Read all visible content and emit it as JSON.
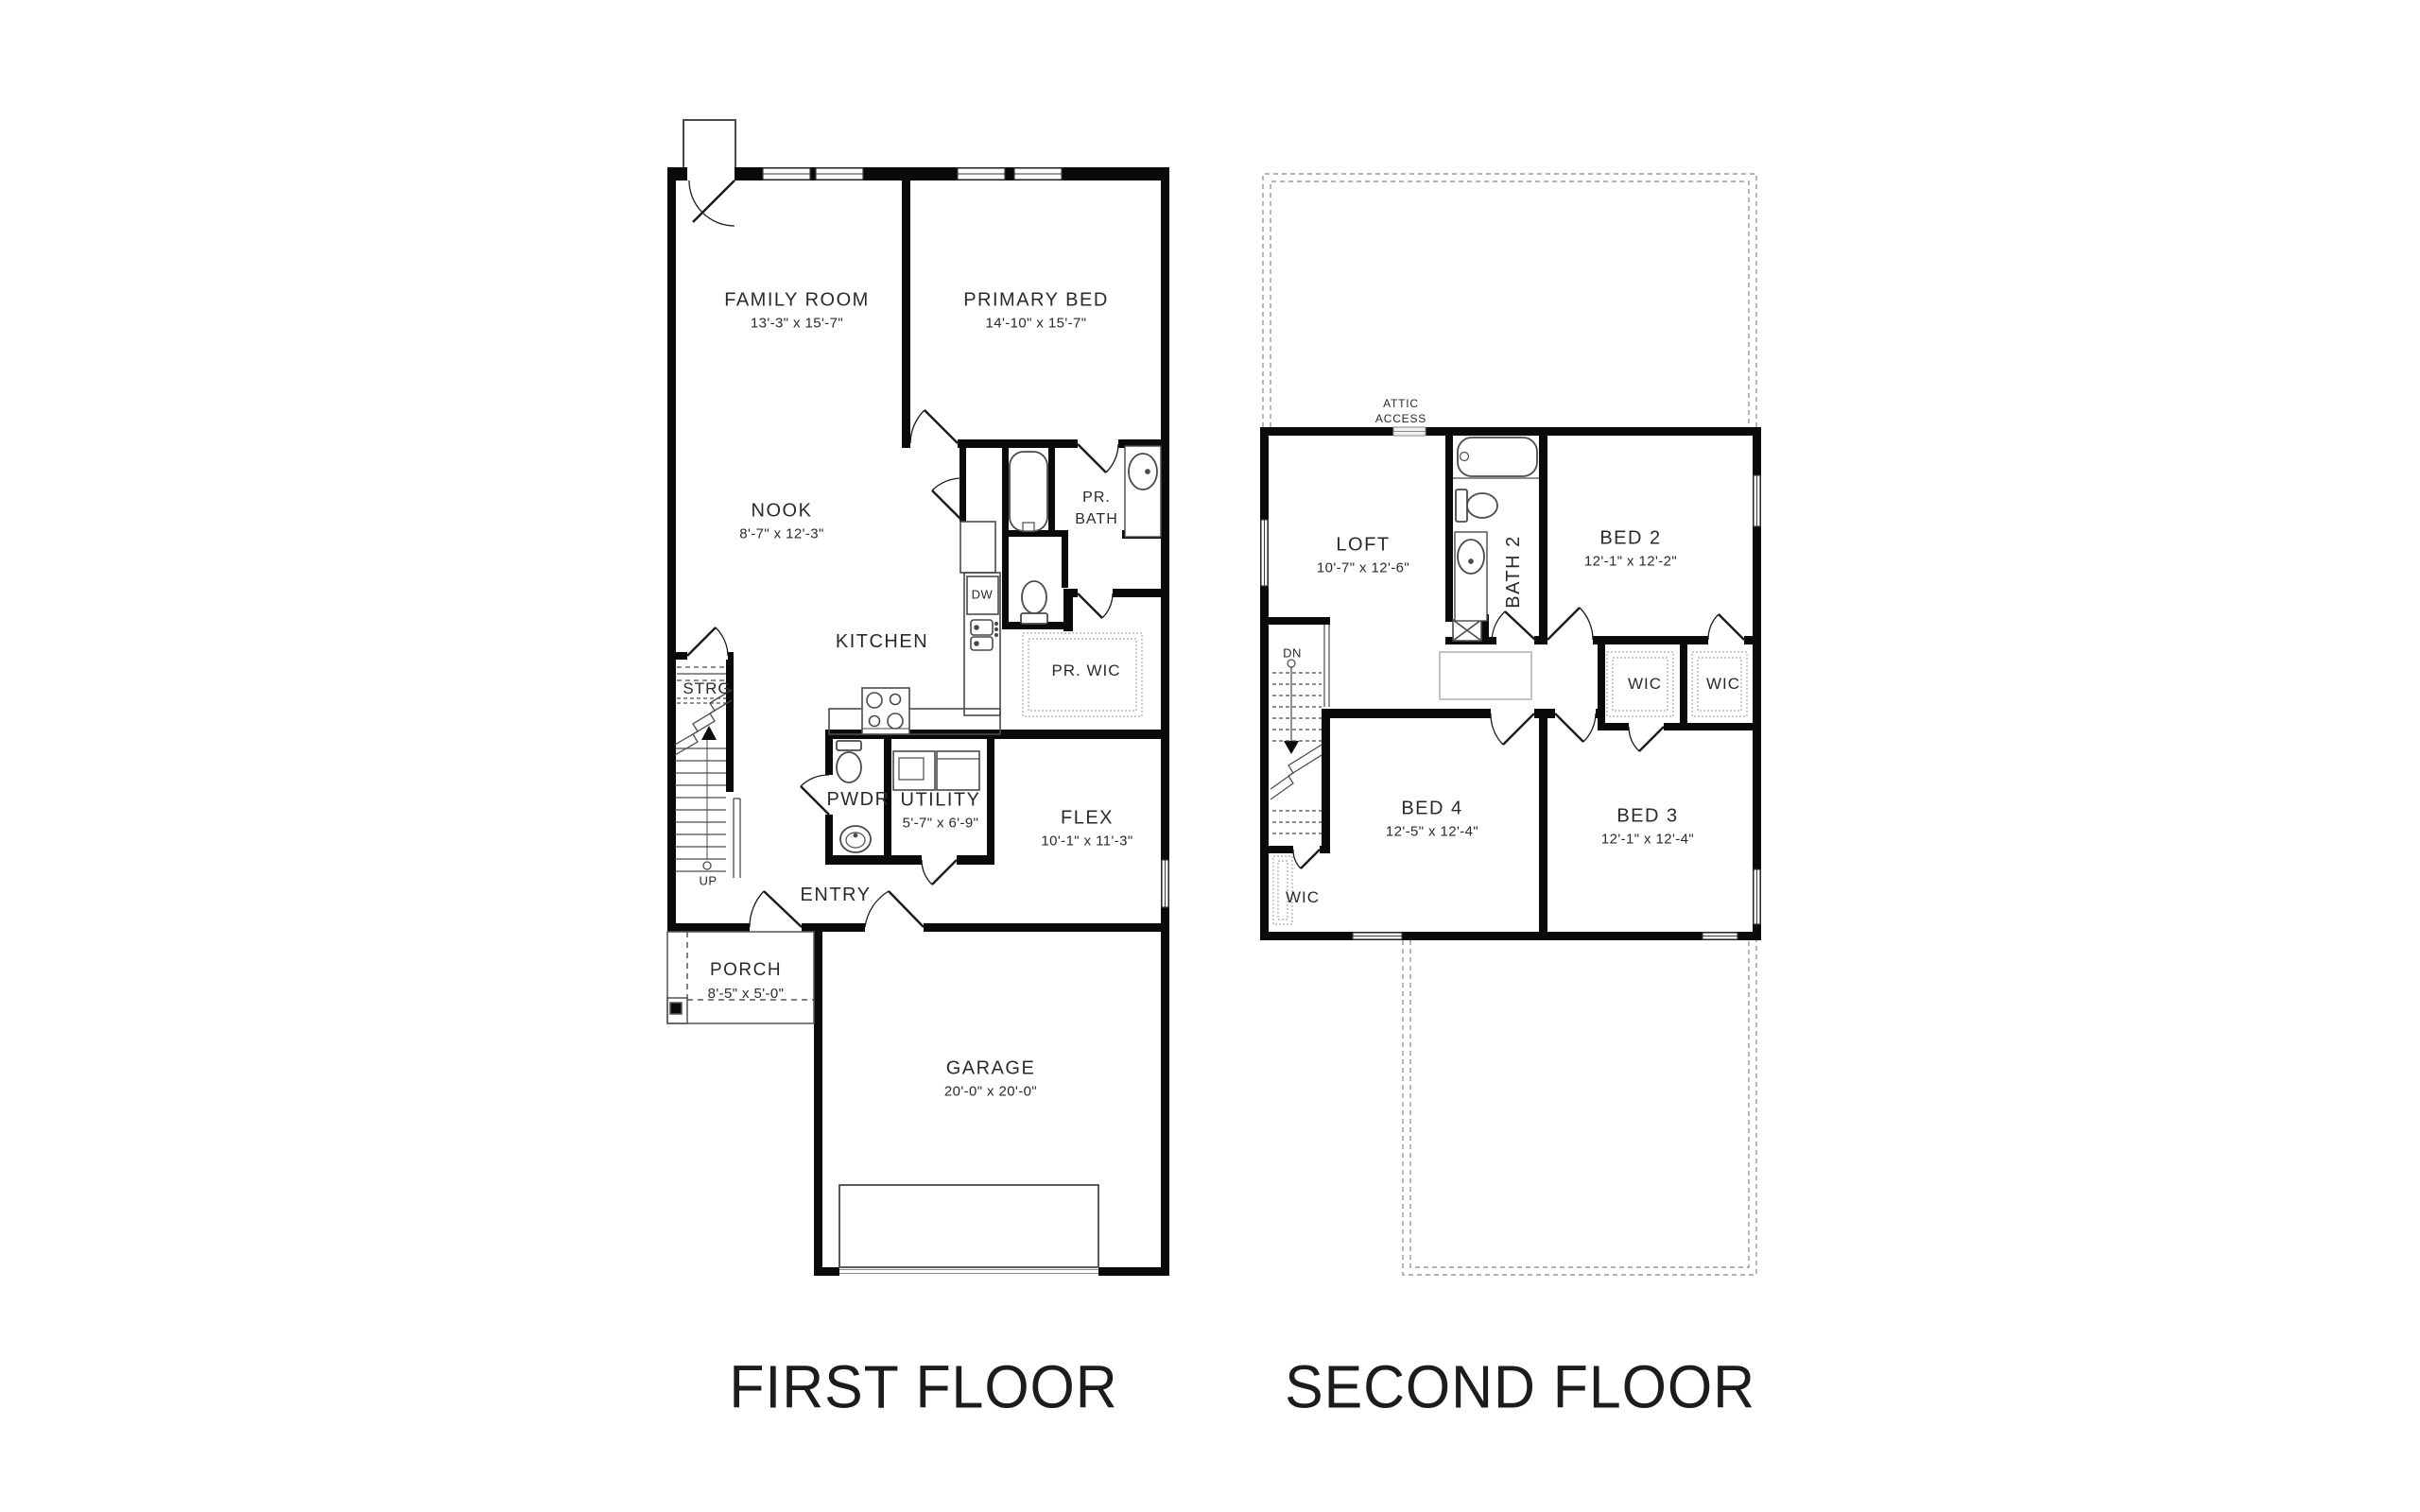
{
  "first": {
    "title": "FIRST FLOOR",
    "rooms": {
      "family": {
        "name": "FAMILY ROOM",
        "dims": "13'-3\" x 15'-7\""
      },
      "primary": {
        "name": "PRIMARY BED",
        "dims": "14'-10\" x 15'-7\""
      },
      "nook": {
        "name": "NOOK",
        "dims": "8'-7\" x 12'-3\""
      },
      "prbath": {
        "line1": "PR.",
        "line2": "BATH"
      },
      "kitchen": {
        "name": "KITCHEN"
      },
      "dw": {
        "name": "DW"
      },
      "prwic": {
        "name": "PR. WIC"
      },
      "strg": {
        "name": "STRG"
      },
      "up": {
        "name": "UP"
      },
      "pwdr": {
        "name": "PWDR"
      },
      "utility": {
        "name": "UTILITY",
        "dims": "5'-7\" x 6'-9\""
      },
      "flex": {
        "name": "FLEX",
        "dims": "10'-1\" x 11'-3\""
      },
      "entry": {
        "name": "ENTRY"
      },
      "porch": {
        "name": "PORCH",
        "dims": "8'-5\" x 5'-0\""
      },
      "garage": {
        "name": "GARAGE",
        "dims": "20'-0\" x 20'-0\""
      }
    }
  },
  "second": {
    "title": "SECOND FLOOR",
    "rooms": {
      "attic": {
        "line1": "ATTIC",
        "line2": "ACCESS"
      },
      "loft": {
        "name": "LOFT",
        "dims": "10'-7\" x 12'-6\""
      },
      "bath2": {
        "name": "BATH 2"
      },
      "bed2": {
        "name": "BED 2",
        "dims": "12'-1\" x 12'-2\""
      },
      "wic_a": {
        "name": "WIC"
      },
      "wic_b": {
        "name": "WIC"
      },
      "dn": {
        "name": "DN"
      },
      "bed4": {
        "name": "BED 4",
        "dims": "12'-5\" x 12'-4\""
      },
      "bed3": {
        "name": "BED 3",
        "dims": "12'-1\" x 12'-4\""
      },
      "wic_c": {
        "name": "WIC"
      }
    }
  },
  "colors": {
    "wall": "#0a0a0a",
    "line": "#4a4a4a",
    "dash": "#999999",
    "text": "#2a2a2a"
  }
}
